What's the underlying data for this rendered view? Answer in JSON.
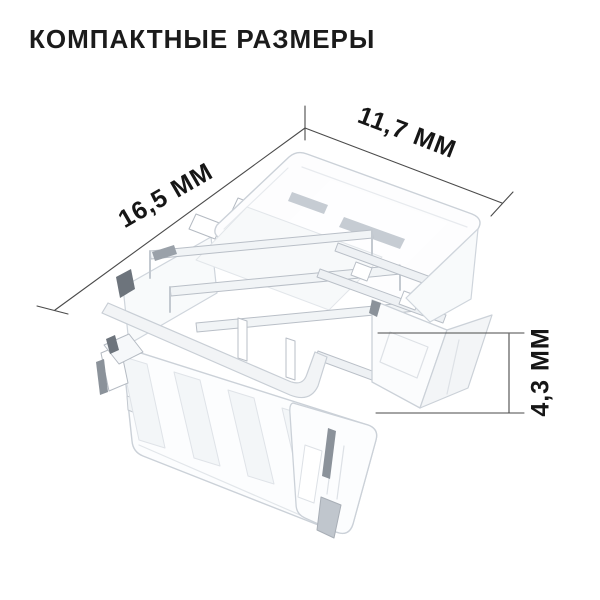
{
  "title": "КОМПАКТНЫЕ РАЗМЕРЫ",
  "dimensions": {
    "width_label": "16,5 ММ",
    "depth_label": "11,7 ММ",
    "height_label": "4,3 ММ"
  },
  "colors": {
    "background": "#ffffff",
    "title_text": "#1b1b1b",
    "dimension_text": "#161616",
    "dimension_line": "#4a4a4a",
    "product_edge_light": "#cbd1d8",
    "product_edge_mid": "#b4bac2",
    "product_fill": "#fcfdfe",
    "product_accent_dark": "#6d747c"
  }
}
